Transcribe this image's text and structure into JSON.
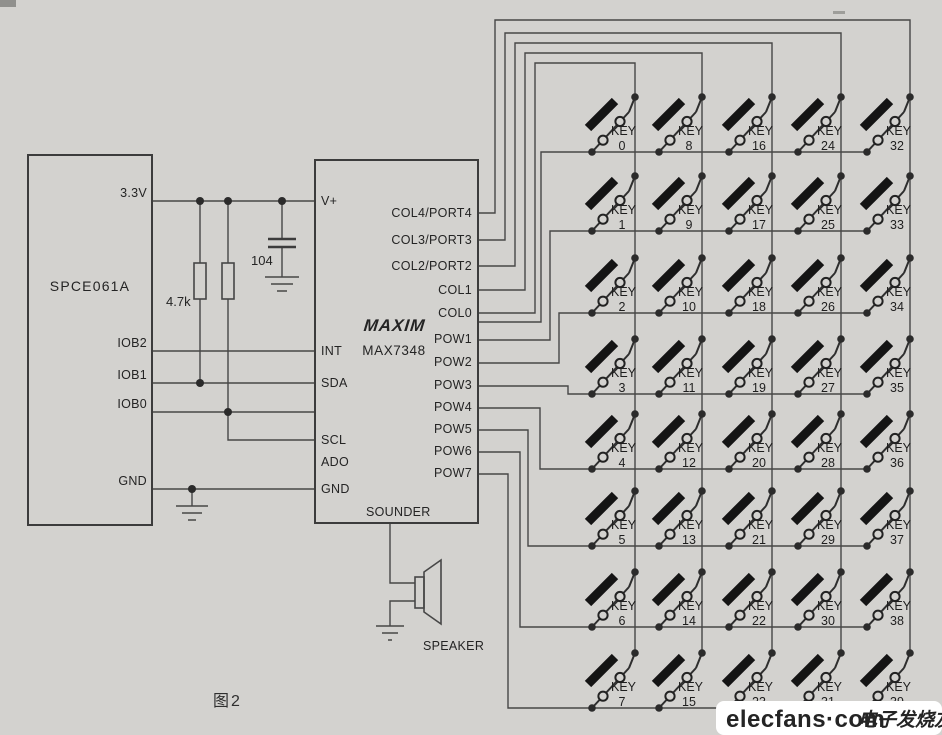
{
  "figure": {
    "caption": "图2"
  },
  "watermark": {
    "brand": "elecfans·com",
    "tagline": "电子发烧友",
    "brand_color": "#c5201f",
    "tagline_color": "#7c1d13"
  },
  "mcu": {
    "name": "SPCE061A",
    "pins": [
      "3.3V",
      "IOB2",
      "IOB1",
      "IOB0",
      "GND"
    ]
  },
  "keyscan": {
    "brand": "MAXIM",
    "part": "MAX7348",
    "left_pins": [
      "V+",
      "INT",
      "SDA",
      "SCL",
      "ADO",
      "GND"
    ],
    "right_pins": [
      "COL4/PORT4",
      "COL3/PORT3",
      "COL2/PORT2",
      "COL1",
      "COL0",
      "POW1",
      "POW2",
      "POW3",
      "POW4",
      "POW5",
      "POW6",
      "POW7"
    ],
    "bottom_pin": "SOUNDER"
  },
  "components": {
    "pullup_resistors": "4.7k",
    "decoupling_cap": "104",
    "speaker_label": "SPEAKER"
  },
  "matrix": {
    "rows": 8,
    "cols": 5,
    "key_prefix": "KEY",
    "key_numbers": [
      [
        0,
        1,
        2,
        3,
        4,
        5,
        6,
        7
      ],
      [
        8,
        9,
        10,
        11,
        12,
        13,
        14,
        15
      ],
      [
        16,
        17,
        18,
        19,
        20,
        21,
        22,
        23
      ],
      [
        24,
        25,
        26,
        27,
        28,
        29,
        30,
        31
      ],
      [
        32,
        33,
        34,
        35,
        36,
        37,
        38,
        39
      ]
    ]
  },
  "colors": {
    "paper": "#d3d2cf",
    "ink": "#474747"
  }
}
